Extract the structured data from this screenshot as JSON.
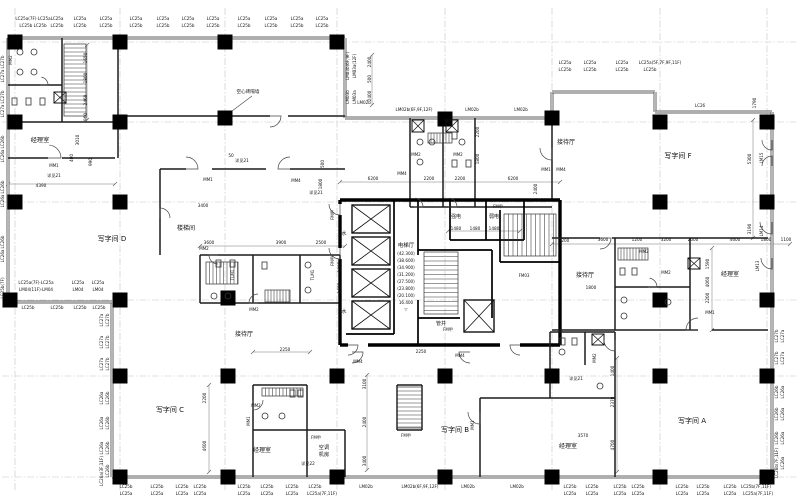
{
  "colors": {
    "background": "#ffffff",
    "wall_core": "#000000",
    "wall_window": "#616161",
    "partition": "#1c1c1c",
    "grid_line": "#c2c6c8",
    "dimension_line": "#666666",
    "text": "#101010"
  },
  "rooms": [
    [
      "经理室",
      40,
      142,
      0,
      6.2
    ],
    [
      "写字间  D",
      112,
      241,
      0,
      7
    ],
    [
      "写字间  C",
      170,
      412,
      0,
      7
    ],
    [
      "写字间  B",
      455,
      432,
      0,
      7
    ],
    [
      "写字间  A",
      692,
      423,
      0,
      7
    ],
    [
      "写字间  F",
      678,
      158,
      0,
      7
    ],
    [
      "接待厅",
      244,
      336,
      0,
      6
    ],
    [
      "接待厅",
      566,
      144,
      0,
      6
    ],
    [
      "接待厅",
      585,
      277,
      0,
      6
    ],
    [
      "经理室",
      262,
      452,
      0,
      6
    ],
    [
      "经理室",
      568,
      448,
      0,
      6
    ],
    [
      "经理室",
      730,
      276,
      0,
      6
    ],
    [
      "空调",
      324,
      449,
      0,
      5.2
    ],
    [
      "机房",
      324,
      456,
      0,
      5.2
    ],
    [
      "楼梯间",
      186,
      230,
      0,
      6
    ],
    [
      "电梯厅",
      406,
      247,
      0,
      5.4
    ]
  ],
  "shaft_labels": [
    [
      "水",
      344,
      235
    ],
    [
      "水",
      344,
      313
    ],
    [
      "强电",
      456,
      218
    ],
    [
      "弱电",
      494,
      218
    ],
    [
      "管井",
      441,
      325
    ]
  ],
  "elevator_levels": [
    [
      "(42.300)",
      406,
      255
    ],
    [
      "(38.600)",
      406,
      262
    ],
    [
      "(34.900)",
      406,
      269
    ],
    [
      "(31.200)",
      406,
      276
    ],
    [
      "(27.500)",
      406,
      283
    ],
    [
      "(23.800)",
      406,
      290
    ],
    [
      "(20.100)",
      406,
      297
    ],
    [
      "16.400",
      406,
      304
    ],
    [
      "▽",
      406,
      311
    ]
  ],
  "fenestration_labels": [
    [
      "LC25a(7F)·LC25a",
      33,
      20
    ],
    [
      "LC25a",
      57,
      20
    ],
    [
      "LC25a",
      80,
      20
    ],
    [
      "LC25a",
      106,
      20
    ],
    [
      "LC25a",
      136,
      20
    ],
    [
      "LC25a",
      163,
      20
    ],
    [
      "LC25a",
      188,
      20
    ],
    [
      "LC25a",
      213,
      20
    ],
    [
      "LC25a",
      244,
      20
    ],
    [
      "LC25a",
      271,
      20
    ],
    [
      "LC25a",
      297,
      20
    ],
    [
      "LC25a",
      322,
      20
    ],
    [
      "LC25b  LC25b",
      33,
      27
    ],
    [
      "LC25b",
      57,
      27
    ],
    [
      "LC25b",
      80,
      27
    ],
    [
      "LC25b",
      106,
      27
    ],
    [
      "LC25b",
      136,
      27
    ],
    [
      "LC25b",
      163,
      27
    ],
    [
      "LC25b",
      188,
      27
    ],
    [
      "LC25b",
      213,
      27
    ],
    [
      "LC25b",
      244,
      27
    ],
    [
      "LC25b",
      271,
      27
    ],
    [
      "LC25b",
      297,
      27
    ],
    [
      "LC25b",
      322,
      27
    ],
    [
      "LC25a",
      565,
      64
    ],
    [
      "LC25a",
      590,
      64
    ],
    [
      "LC25a",
      622,
      64
    ],
    [
      "LC25a(5F,7F,9F,11F)",
      660,
      64
    ],
    [
      "LC25b",
      565,
      71
    ],
    [
      "LC25b",
      590,
      71
    ],
    [
      "LC25b",
      622,
      71
    ],
    [
      "LC25b",
      650,
      71
    ],
    [
      "LC26",
      700,
      107
    ],
    [
      "LM02b",
      364,
      104
    ],
    [
      "LM02b(6F,9F,12F)",
      414,
      111
    ],
    [
      "LM02b",
      472,
      111
    ],
    [
      "LM02b",
      521,
      111
    ],
    [
      "LM03b(6F,9F)",
      349,
      66,
      -90
    ],
    [
      "LM03a(12F)",
      356,
      66,
      -90
    ],
    [
      "LM03b",
      349,
      97,
      -90
    ],
    [
      "LM03a",
      356,
      97,
      -90
    ],
    [
      "LC25a(7F)·LC25a",
      36,
      284
    ],
    [
      "LC25a",
      78,
      284
    ],
    [
      "LC25a",
      98,
      284
    ],
    [
      "LM04(11F)·LM04",
      36,
      291
    ],
    [
      "LM04",
      78,
      291
    ],
    [
      "LM04",
      98,
      291
    ],
    [
      "LC25b",
      28,
      309
    ],
    [
      "LC25b",
      57,
      309
    ],
    [
      "LC25b",
      80,
      309
    ],
    [
      "LC25b",
      99,
      309
    ],
    [
      "LC25b",
      126,
      488
    ],
    [
      "LC25b",
      157,
      488
    ],
    [
      "LC25b",
      182,
      488
    ],
    [
      "LC25b",
      200,
      488
    ],
    [
      "LC25b",
      244,
      488
    ],
    [
      "LC25b",
      267,
      488
    ],
    [
      "LC25b",
      292,
      488
    ],
    [
      "LC25b",
      315,
      488
    ],
    [
      "LM02b",
      366,
      488
    ],
    [
      "LM02b(6F,9F,12F)",
      420,
      488
    ],
    [
      "LM02b",
      468,
      488
    ],
    [
      "LM02b",
      517,
      488
    ],
    [
      "LC25b",
      570,
      488
    ],
    [
      "LC25b",
      592,
      488
    ],
    [
      "LC25b",
      620,
      488
    ],
    [
      "LC25b",
      638,
      488
    ],
    [
      "LC25b",
      682,
      488
    ],
    [
      "LC25b",
      703,
      488
    ],
    [
      "LC25b",
      730,
      488
    ],
    [
      "LC25b(7F,11F)",
      756,
      488
    ],
    [
      "LC25a",
      126,
      495
    ],
    [
      "LC25a",
      157,
      495
    ],
    [
      "LC25a",
      182,
      495
    ],
    [
      "LC25a",
      200,
      495
    ],
    [
      "LC25a",
      244,
      495
    ],
    [
      "LC25a",
      267,
      495
    ],
    [
      "LC25a",
      292,
      495
    ],
    [
      "LC25a(7F,11F)",
      322,
      495
    ],
    [
      "LC25a",
      570,
      495
    ],
    [
      "LC25a",
      592,
      495
    ],
    [
      "LC25a",
      620,
      495
    ],
    [
      "LC25a",
      638,
      495
    ],
    [
      "LC25a",
      682,
      495
    ],
    [
      "LC25a",
      703,
      495
    ],
    [
      "LC25a",
      730,
      495
    ],
    [
      "LC25a(7F,11F)",
      758,
      495
    ],
    [
      "LC27b",
      4,
      62,
      -90
    ],
    [
      "LC27a",
      4,
      76,
      -90
    ],
    [
      "LC27b",
      4,
      97,
      -90
    ],
    [
      "LC27a",
      4,
      111,
      -90
    ],
    [
      "LC26b",
      4,
      142,
      -90
    ],
    [
      "LC26a",
      4,
      156,
      -90
    ],
    [
      "LC26b",
      4,
      187,
      -90
    ],
    [
      "LC26a",
      4,
      201,
      -90
    ],
    [
      "LC26b",
      4,
      242,
      -90
    ],
    [
      "LC26a",
      4,
      256,
      -90
    ],
    [
      "LC25b(7F)",
      4,
      288,
      -90
    ],
    [
      "LC27a",
      103,
      320,
      -90
    ],
    [
      "LC27b",
      109,
      320,
      -90
    ],
    [
      "LC27a",
      103,
      342,
      -90
    ],
    [
      "LC27b",
      109,
      342,
      -90
    ],
    [
      "LC27a",
      103,
      364,
      -90
    ],
    [
      "LC27b",
      109,
      364,
      -90
    ],
    [
      "LC26a",
      103,
      398,
      -90
    ],
    [
      "LC26b",
      109,
      398,
      -90
    ],
    [
      "LC26a",
      103,
      423,
      -90
    ],
    [
      "LC26b",
      109,
      423,
      -90
    ],
    [
      "LC26a",
      103,
      448,
      -90
    ],
    [
      "LC26b",
      109,
      448,
      -90
    ],
    [
      "LC26a(3F,11F)",
      103,
      471,
      -90
    ],
    [
      "LC26b",
      109,
      471,
      -90
    ],
    [
      "LC27b",
      778,
      336,
      -90
    ],
    [
      "LC27a",
      784,
      336,
      -90
    ],
    [
      "LC27b",
      778,
      358,
      -90
    ],
    [
      "LC27a",
      784,
      358,
      -90
    ],
    [
      "LC26b",
      778,
      392,
      -90
    ],
    [
      "LC26a",
      784,
      392,
      -90
    ],
    [
      "LC26b",
      778,
      414,
      -90
    ],
    [
      "LC26a",
      784,
      414,
      -90
    ],
    [
      "LC26b",
      778,
      438,
      -90
    ],
    [
      "LC26a",
      784,
      438,
      -90
    ],
    [
      "LC26b(7F,11F)",
      778,
      463,
      -90
    ],
    [
      "LC26a",
      784,
      463,
      -90
    ]
  ],
  "door_labels": [
    [
      "MM1",
      54,
      167
    ],
    [
      "MM2",
      12,
      60,
      -90
    ],
    [
      "MM1",
      208,
      181
    ],
    [
      "MM4",
      296,
      182
    ],
    [
      "MM4",
      402,
      175
    ],
    [
      "MM2",
      416,
      156
    ],
    [
      "MM2",
      458,
      156
    ],
    [
      "MM1",
      546,
      171
    ],
    [
      "MM4",
      561,
      171
    ],
    [
      "MM2",
      204,
      250
    ],
    [
      "MM2",
      254,
      311
    ],
    [
      "TLM1",
      234,
      275,
      -90
    ],
    [
      "TLM1",
      314,
      275,
      -90
    ],
    [
      "FM甲",
      334,
      215,
      -90
    ],
    [
      "FM甲",
      334,
      261,
      -90
    ],
    [
      "FM甲",
      498,
      208
    ],
    [
      "FM甲",
      448,
      331
    ],
    [
      "FM03",
      524,
      277
    ],
    [
      "MM4",
      358,
      363
    ],
    [
      "MM4",
      460,
      357
    ],
    [
      "MM1",
      250,
      421,
      -90
    ],
    [
      "MM2",
      256,
      407
    ],
    [
      "FM甲",
      316,
      439
    ],
    [
      "FM甲",
      406,
      437
    ],
    [
      "MM1",
      474,
      425,
      -90
    ],
    [
      "MM2",
      596,
      358,
      -90
    ],
    [
      "MM2",
      644,
      253
    ],
    [
      "MM2",
      666,
      274
    ],
    [
      "MM1",
      710,
      314
    ],
    [
      "LM15",
      763,
      158,
      -90
    ],
    [
      "LM14",
      763,
      231,
      -90
    ],
    [
      "LM13",
      759,
      266,
      -90
    ]
  ],
  "dimension_labels": [
    [
      "1650",
      87,
      58,
      -90
    ],
    [
      "1800",
      87,
      78,
      -90
    ],
    [
      "2460",
      87,
      100,
      -90
    ],
    [
      "960",
      87,
      117,
      -90
    ],
    [
      "3010",
      79,
      140,
      -90
    ],
    [
      "400",
      73,
      158,
      -90
    ],
    [
      "990",
      92,
      162,
      -90
    ],
    [
      "4390",
      41,
      187
    ],
    [
      "详见21",
      54,
      177
    ],
    [
      "50",
      231,
      157
    ],
    [
      "详见21",
      242,
      162
    ],
    [
      "500",
      324,
      164,
      -90
    ],
    [
      "1800",
      322,
      184,
      -90
    ],
    [
      "详见21",
      316,
      194
    ],
    [
      "3400",
      203,
      207
    ],
    [
      "3600",
      209,
      244
    ],
    [
      "3900",
      281,
      244
    ],
    [
      "2500",
      321,
      244
    ],
    [
      "1800",
      341,
      267,
      -90
    ],
    [
      "1600",
      341,
      288,
      -90
    ],
    [
      "2400",
      371,
      62,
      -90
    ],
    [
      "500",
      371,
      79,
      -90
    ],
    [
      "2400",
      371,
      96,
      -90
    ],
    [
      "6200",
      373,
      180
    ],
    [
      "2200",
      429,
      180
    ],
    [
      "2200",
      460,
      180
    ],
    [
      "6200",
      513,
      180
    ],
    [
      "2400",
      537,
      189,
      -90
    ],
    [
      "1480",
      456,
      230
    ],
    [
      "1480",
      475,
      230
    ],
    [
      "1480",
      494,
      230
    ],
    [
      "2200",
      479,
      132,
      -90
    ],
    [
      "1800",
      479,
      159,
      -90
    ],
    [
      "2250",
      285,
      351
    ],
    [
      "2250",
      421,
      353
    ],
    [
      "2200",
      206,
      398,
      -90
    ],
    [
      "4600",
      206,
      446,
      -90
    ],
    [
      "3100",
      366,
      384,
      -90
    ],
    [
      "2400",
      366,
      422,
      -90
    ],
    [
      "3400",
      366,
      461,
      -90
    ],
    [
      "1400",
      614,
      371,
      -90
    ],
    [
      "2370",
      614,
      402,
      -90
    ],
    [
      "4700",
      614,
      445,
      -90
    ],
    [
      "3570",
      583,
      437
    ],
    [
      "详见21",
      576,
      380
    ],
    [
      "详见22",
      308,
      465
    ],
    [
      "1590",
      709,
      264,
      -90
    ],
    [
      "4060",
      709,
      282,
      -90
    ],
    [
      "2200",
      709,
      298,
      -90
    ],
    [
      "2200",
      564,
      242
    ],
    [
      "3600",
      603,
      241
    ],
    [
      "1200",
      637,
      241
    ],
    [
      "3200",
      666,
      241
    ],
    [
      "2000",
      693,
      241
    ],
    [
      "4600",
      735,
      241
    ],
    [
      "1800",
      766,
      241
    ],
    [
      "1100",
      786,
      241
    ],
    [
      "1790",
      756,
      103,
      -90
    ],
    [
      "5300",
      751,
      159,
      -90
    ],
    [
      "3190",
      751,
      229,
      -90
    ],
    [
      "1800",
      591,
      289
    ]
  ],
  "annotations": [
    [
      "空心砖隔墙",
      248,
      93
    ]
  ]
}
